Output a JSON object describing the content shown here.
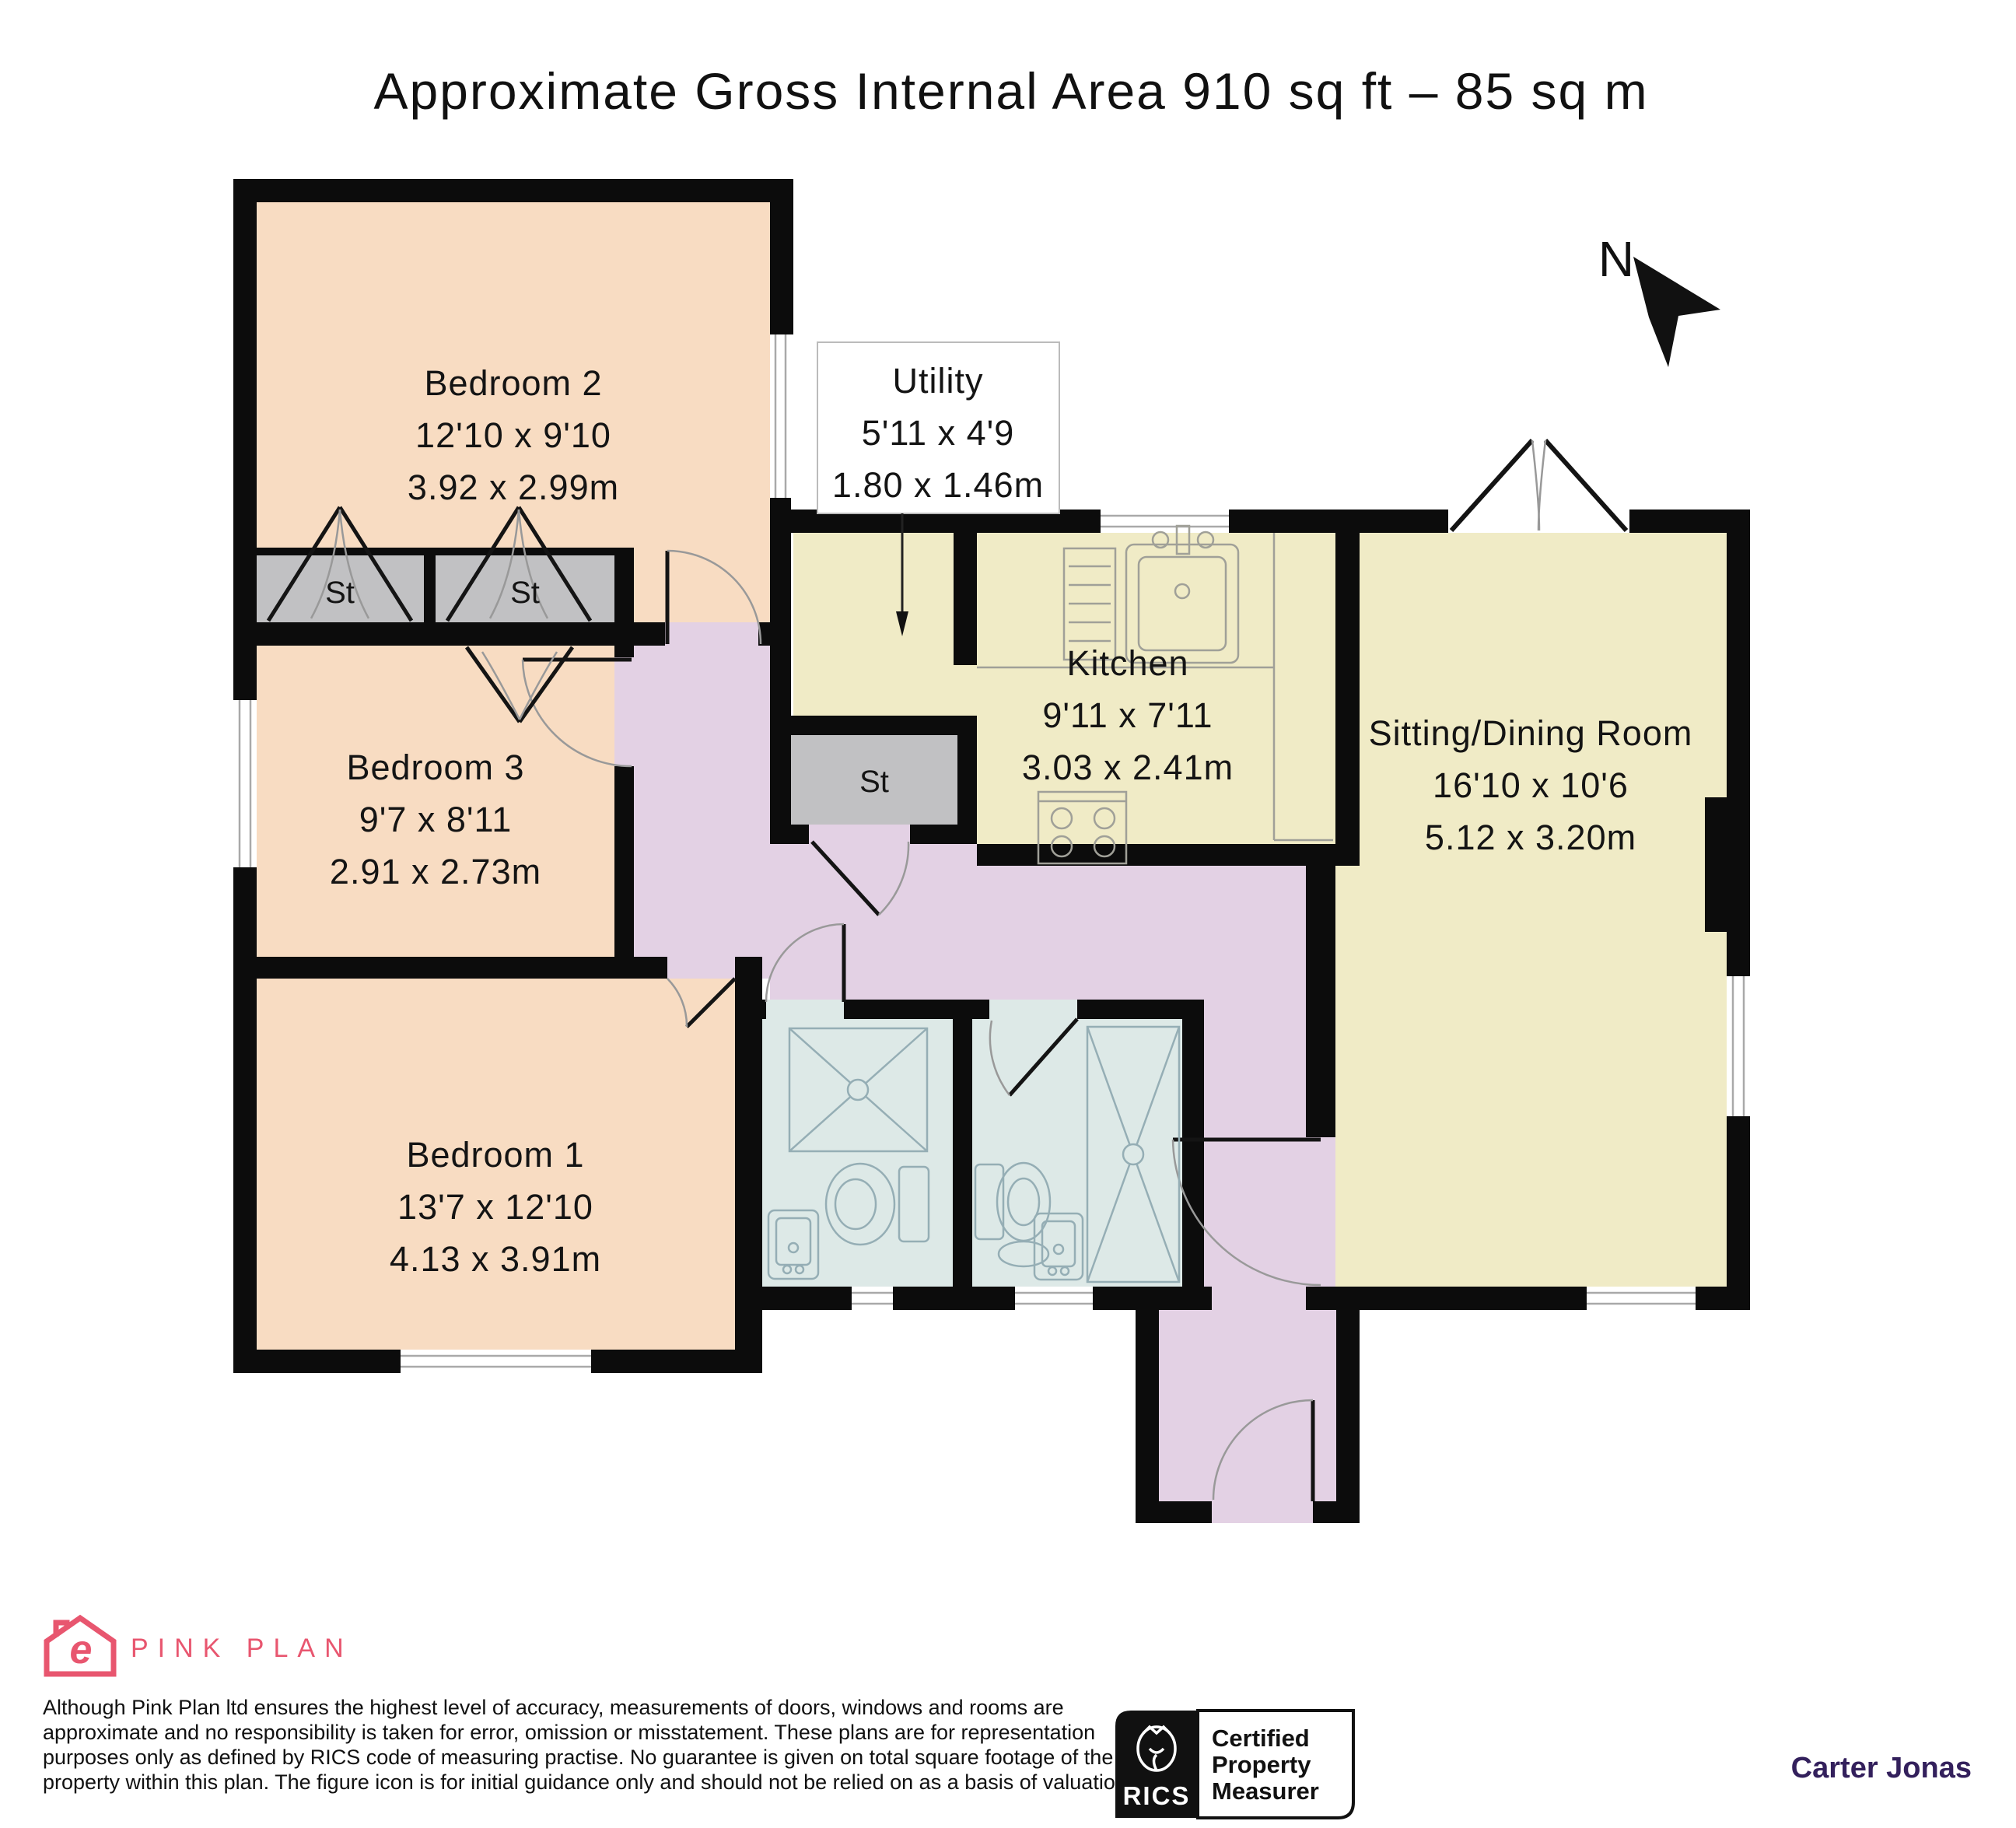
{
  "title": "Approximate Gross Internal Area 910 sq ft – 85 sq m",
  "north_label": "N",
  "rooms": {
    "bedroom2": {
      "name": "Bedroom 2",
      "imperial": "12'10 x 9'10",
      "metric": "3.92 x 2.99m"
    },
    "utility": {
      "name": "Utility",
      "imperial": "5'11 x 4'9",
      "metric": "1.80 x 1.46m"
    },
    "kitchen": {
      "name": "Kitchen",
      "imperial": "9'11 x 7'11",
      "metric": "3.03 x 2.41m"
    },
    "sitting": {
      "name": "Sitting/Dining Room",
      "imperial": "16'10 x 10'6",
      "metric": "5.12 x 3.20m"
    },
    "bedroom3": {
      "name": "Bedroom 3",
      "imperial": "9'7 x 8'11",
      "metric": "2.91 x 2.73m"
    },
    "bedroom1": {
      "name": "Bedroom 1",
      "imperial": "13'7 x 12'10",
      "metric": "4.13 x 3.91m"
    },
    "storage": {
      "label": "St"
    }
  },
  "footer": {
    "logo_text": "PINK PLAN",
    "logo_glyph": "e",
    "disclaimer_lines": [
      "Although Pink Plan ltd ensures the highest level of accuracy, measurements of doors, windows and rooms are",
      "approximate and no responsibility is taken for error, omission or misstatement. These plans are for representation",
      "purposes only as defined by RICS code of measuring practise. No guarantee is given on total square footage of the",
      "property within this plan. The figure icon is for initial guidance only and should not be relied on as a basis of valuation."
    ],
    "rics": {
      "name": "RICS",
      "line1": "Certified",
      "line2": "Property",
      "line3": "Measurer"
    },
    "brand": "Carter Jonas"
  },
  "colors": {
    "wall": "#0c0c0c",
    "bedroom_fill": "#f8dcc2",
    "living_fill": "#f0ebc6",
    "hall_fill": "#e3d1e4",
    "bath_fill": "#dde9e7",
    "storage_fill": "#c1c1c3",
    "logo_pink": "#e8566f",
    "brand_purple": "#33205c"
  }
}
